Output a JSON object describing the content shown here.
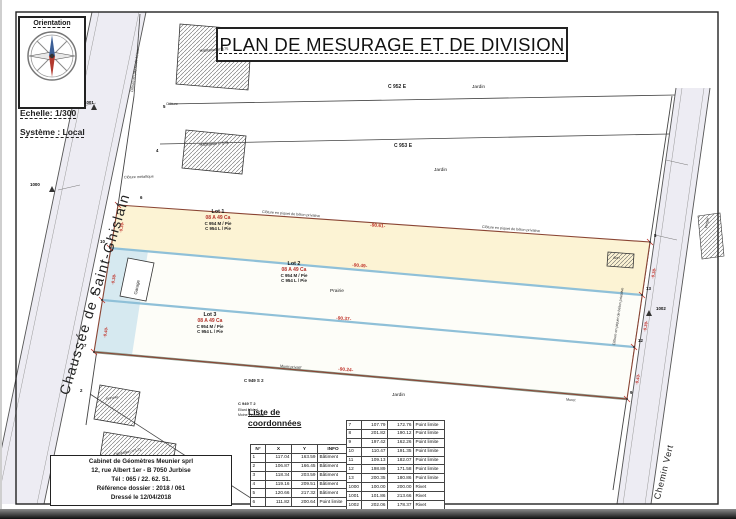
{
  "page": {
    "title": "PLAN DE MESURAGE ET DE DIVISION",
    "orientation_label": "Orientation",
    "scale_label": "Echelle: 1/300",
    "system_label": "Système : Local"
  },
  "colors": {
    "dimension_red": "#c0332a",
    "area_label_red": "#b5322a",
    "lot1_fill_cream": "#fcf3d4",
    "lot_edge_blue": "#8fc0d8",
    "road_fill": "#edecf3",
    "division_boundary_brown": "#8a4534",
    "muret_gray_green": "#8c9b8c"
  },
  "plan": {
    "road_left": "Chaussée de Saint-Ghislain",
    "road_right": "Chemin Vert",
    "lots": [
      {
        "name": "Lot 1",
        "area": "08 A 49 Ca",
        "cad_1": "C 954 M / Pie",
        "cad_2": "C 954 L / Pie",
        "length": "-90.61-"
      },
      {
        "name": "Lot 2",
        "area": "08 A 49 Ca",
        "cad_1": "C 954 M / Pie",
        "cad_2": "C 954 L / Pie",
        "length": "-90.49-"
      },
      {
        "name": "Lot 3",
        "area": "08 A 49 Ca",
        "cad_1": "C 954 M / Pie",
        "cad_2": "C 954 L / Pie",
        "length": "-90.37-"
      }
    ],
    "widths_left": [
      "-9.39-",
      "-9.38-",
      "-9.40-"
    ],
    "widths_right": [
      "-9.38-",
      "-9.39-",
      "-9.43-"
    ],
    "bottom_length": "-90.24-",
    "parcels": {
      "c952": "C 952 E",
      "c953": "C 953 E",
      "c949s": "C 949 S 2",
      "c949t": "C 949 T 2",
      "jardin": "Jardin",
      "prairie": "Prairie",
      "verger": "Verger"
    },
    "owners": {
      "line1": "Eliard Michel",
      "line2": "Moine Véronique"
    },
    "buildings": {
      "hab175": "Habitation n°175",
      "hab173": "Habitation n°173",
      "hab171": "Habitation n°171",
      "annexe": "Annexe",
      "garage": "Garage",
      "abri": "Abri"
    },
    "fences": {
      "cloture": "Clôture",
      "metallique": "Clôture métallique",
      "beton": "Clôture en piquet de béton",
      "beton_privative": "Clôture en piquet de béton privative"
    },
    "walls": {
      "muret": "Muret",
      "muret_privatif": "Muret privatif"
    },
    "points": {
      "p2": "2",
      "p4": "4",
      "p5": "5",
      "p6": "6",
      "p7": "7",
      "p8": "8",
      "p9": "9",
      "p10": "10",
      "p11": "11",
      "p12": "12",
      "p13": "13",
      "p1000": "1000",
      "p1001": "1001",
      "p1002": "1002"
    }
  },
  "coords": {
    "heading_line1": "Liste de",
    "heading_line2": "coordonnées",
    "headers": [
      "N°",
      "X",
      "Y",
      "INFO"
    ],
    "left_rows": [
      [
        "1",
        "117.04",
        "163.59",
        "Bâtiment"
      ],
      [
        "2",
        "106.87",
        "166.45",
        "Bâtiment"
      ],
      [
        "3",
        "118.34",
        "203.59",
        "Bâtiment"
      ],
      [
        "4",
        "119.16",
        "209.51",
        "Bâtiment"
      ],
      [
        "5",
        "120.66",
        "217.32",
        "Bâtiment"
      ],
      [
        "6",
        "111.82",
        "200.64",
        "Point limite"
      ]
    ],
    "right_rows": [
      [
        "7",
        "107.79",
        "172.76",
        "Point limite"
      ],
      [
        "8",
        "201.82",
        "190.12",
        "Point limite"
      ],
      [
        "9",
        "197.42",
        "162.26",
        "Point limite"
      ],
      [
        "10",
        "110.47",
        "191.35",
        "Point limite"
      ],
      [
        "11",
        "109.13",
        "182.07",
        "Point limite"
      ],
      [
        "12",
        "198.89",
        "171.58",
        "Point limite"
      ],
      [
        "13",
        "200.35",
        "180.86",
        "Point limite"
      ],
      [
        "1000",
        "100.00",
        "200.00",
        "Rivet"
      ],
      [
        "1001",
        "101.86",
        "213.66",
        "Rivet"
      ],
      [
        "1002",
        "202.06",
        "178.37",
        "Rivet"
      ]
    ]
  },
  "cabinet": {
    "line1": "Cabinet de Géomètres Meunier sprl",
    "line2": "12, rue Albert 1er - B 7050 Jurbise",
    "line3": "Tél : 065 / 22. 62. 51.",
    "line4": "Référence dossier : 2018 / 061",
    "line5": "Dressé le 12/04/2018"
  }
}
